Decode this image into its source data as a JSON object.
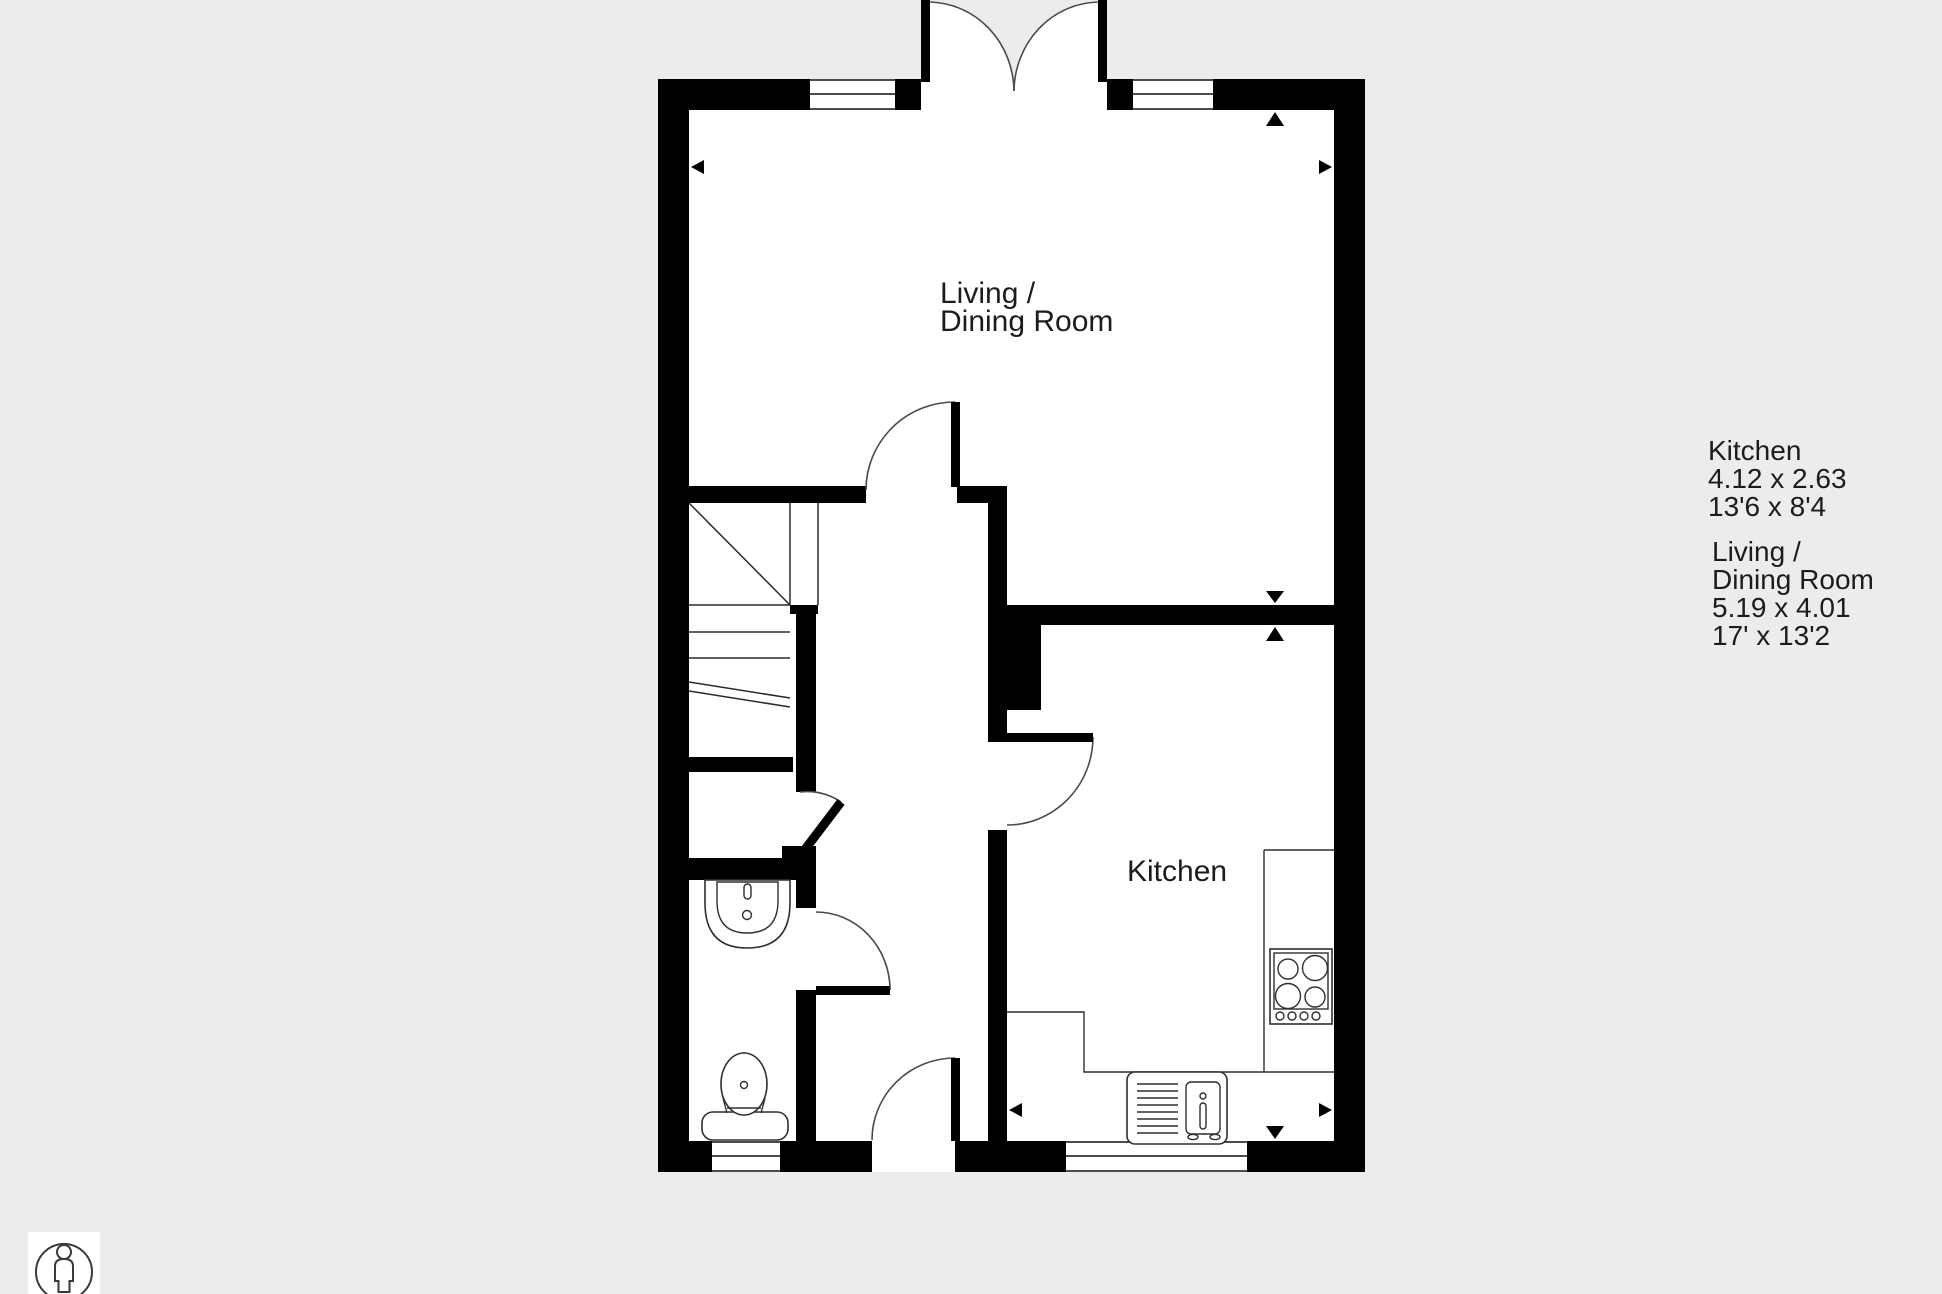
{
  "page": {
    "background_color": "#ececec",
    "plan_fill_color": "#ffffff",
    "wall_color": "#000000",
    "line_color": "#2b2b2b"
  },
  "rooms": {
    "living_dining": {
      "label_line1": "Living /",
      "label_line2": "Dining Room"
    },
    "kitchen": {
      "label": "Kitchen"
    }
  },
  "dimensions_panel": {
    "kitchen": {
      "name": "Kitchen",
      "metric": "4.12 x 2.63",
      "imperial": "13'6 x 8'4"
    },
    "living_dining": {
      "name_line1": "Living /",
      "name_line2": "Dining Room",
      "metric": "5.19 x 4.01",
      "imperial": "17' x 13'2"
    }
  },
  "icons": {
    "person": "person-in-circle-icon",
    "survey_arrows": [
      "left",
      "right",
      "up",
      "down",
      "up",
      "left",
      "right",
      "down"
    ]
  },
  "fixtures": [
    "stairs",
    "under-stairs-cupboard-door",
    "wc-basin",
    "wc-toilet",
    "kitchen-counter",
    "kitchen-sink-drainer-unit",
    "hob"
  ]
}
